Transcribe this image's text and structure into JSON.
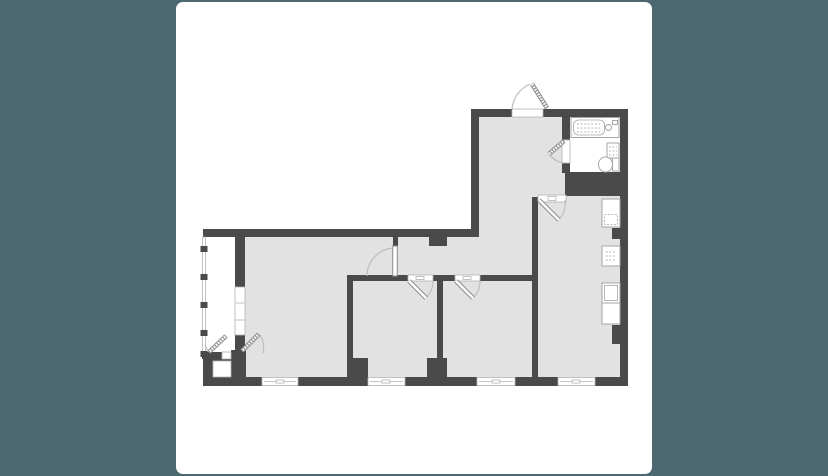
{
  "colors": {
    "background": "#4C6971",
    "card": "#FFFFFF",
    "wall": "#4A4A4A",
    "floor": "#E2E2E2",
    "fixture-line": "#A6A6A6",
    "door-arc": "#BEBEBE",
    "door-leaf": "#8E8E8E",
    "glazing": "#B3B3B3",
    "texture-dot": "#C6C6C6"
  },
  "plan": {
    "type": "apartment-floor-plan",
    "exterior_windows": 4,
    "doors_shown": 8,
    "bath_fixtures": [
      "bathtub",
      "washbasin",
      "toilet"
    ],
    "kitchen_units": 4
  }
}
